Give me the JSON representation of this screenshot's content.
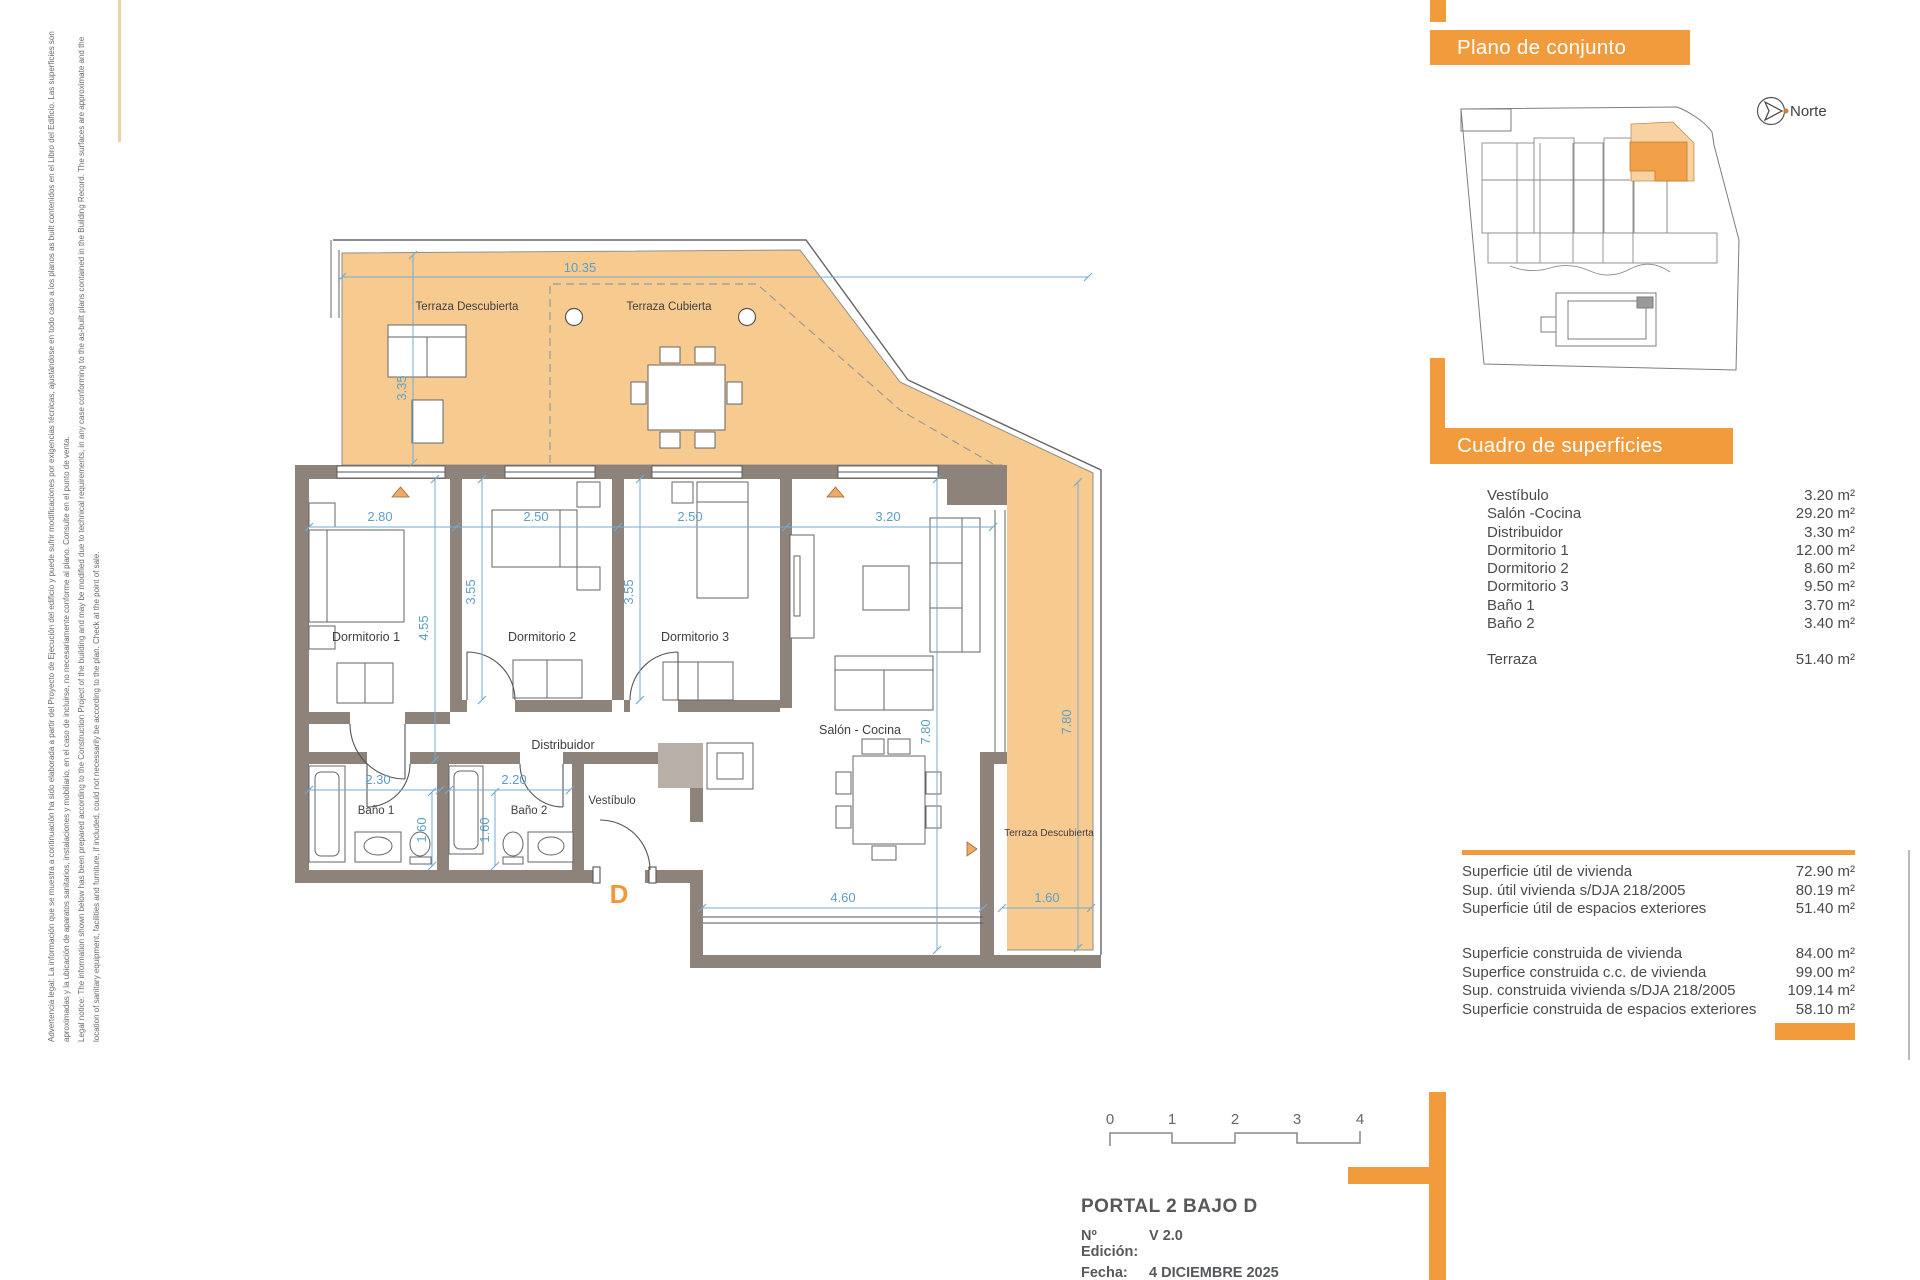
{
  "legal": {
    "line1": "Advertencia legal: La información que se muestra a continuación ha sido elaborada a partir del Proyecto de Ejecución del edificio y puede sufrir modificaciones por exigencias técnicas, ajustándose en todo caso a los planos as built contenidos en el Libro del Edificio. Las superficies son",
    "line2": "aproximadas y la ubicación de aparatos sanitarios, instalaciones y mobiliario, en el caso de incluirse, no necesariamente conforme al plano. Consulte en el punto de venta.",
    "line3": "Legal notice: The information shown below has been prepared according to the Construction Project of the building and may be modified due to technical requirements, in any case conforming to the as-built plans contained in the Building Record. The surfaces are approximate and the",
    "line4": "location of sanitary equipment, facilities and furniture, if included, could not necessarily be according to the plan. Check at the point of sale."
  },
  "site": {
    "header": "Plano de conjunto",
    "north": "Norte"
  },
  "surfaces": {
    "header": "Cuadro de superficies",
    "rows": [
      {
        "label": "Vestíbulo",
        "value": "3.20 m²"
      },
      {
        "label": "Salón -Cocina",
        "value": "29.20 m²"
      },
      {
        "label": "Distribuidor",
        "value": "3.30 m²"
      },
      {
        "label": "Dormitorio 1",
        "value": "12.00 m²"
      },
      {
        "label": "Dormitorio 2",
        "value": "8.60 m²"
      },
      {
        "label": "Dormitorio 3",
        "value": "9.50 m²"
      },
      {
        "label": "Baño 1",
        "value": "3.70 m²"
      },
      {
        "label": "Baño 2",
        "value": "3.40 m²"
      }
    ],
    "terraza": {
      "label": "Terraza",
      "value": "51.40 m²"
    }
  },
  "summary": {
    "useful": [
      {
        "label": "Superficie útil de vivienda",
        "value": "72.90 m²"
      },
      {
        "label": "Sup. útil vivienda s/DJA 218/2005",
        "value": "80.19 m²"
      },
      {
        "label": "Superficie útil de espacios exteriores",
        "value": "51.40 m²"
      }
    ],
    "built": [
      {
        "label": "Superficie construida de vivienda",
        "value": "84.00 m²"
      },
      {
        "label": "Superfice construida c.c. de vivienda",
        "value": "99.00 m²"
      },
      {
        "label": "Sup. construida vivienda s/DJA 218/2005",
        "value": "109.14 m²"
      },
      {
        "label": "Superficie construida de espacios exteriores",
        "value": "58.10 m²"
      }
    ]
  },
  "titleblock": {
    "title": "PORTAL 2  BAJO D",
    "edition_label": "Nº Edición:",
    "edition_value": "V 2.0",
    "date_label": "Fecha:",
    "date_value": "4 DICIEMBRE 2025"
  },
  "scalebar": {
    "t0": "0",
    "t1": "1",
    "t2": "2",
    "t3": "3",
    "t4": "4"
  },
  "plan": {
    "unit": "D",
    "rooms": {
      "terraza_descubierta": "Terraza Descubierta",
      "terraza_cubierta": "Terraza Cubierta",
      "dormitorio1": "Dormitorio 1",
      "dormitorio2": "Dormitorio 2",
      "dormitorio3": "Dormitorio 3",
      "distribuidor": "Distribuidor",
      "salon": "Salón - Cocina",
      "bano1": "Baño 1",
      "bano2": "Baño 2",
      "vestibulo": "Vestíbulo",
      "terraza_descubierta2": "Terraza Descubierta"
    },
    "dims": {
      "top": "10.35",
      "left": "3.35",
      "d1w": "2.80",
      "d2w": "2.50",
      "d3w": "2.50",
      "salonw": "3.20",
      "d1h": "4.55",
      "d2h": "3.55",
      "d3h": "3.55",
      "salonh": "7.80",
      "terr_h": "7.80",
      "b1w": "2.30",
      "b2w": "2.20",
      "b1h": "1.60",
      "b2h": "1.60",
      "salon_bottom": "4.60",
      "terr_w": "1.60"
    }
  },
  "colors": {
    "accent": "#F29B3D",
    "terrace": "#F7CB90",
    "unit_dark": "#F2A149",
    "unit_light": "#F8D2A2",
    "wall": "#8D837A",
    "dim": "#5C9FC6",
    "text": "#57585A"
  }
}
